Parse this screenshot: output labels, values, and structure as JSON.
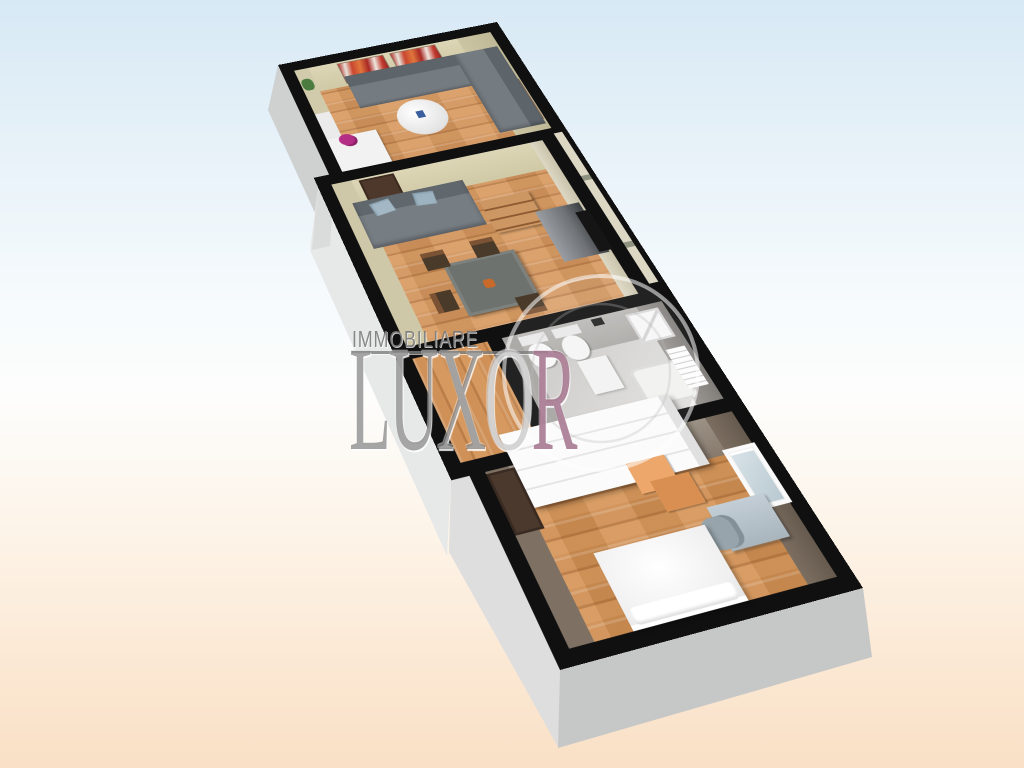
{
  "watermark": {
    "line1": "IMMOBILIARE",
    "logo_word": "LUXOR",
    "logo_letters": [
      "L",
      "U",
      "X",
      "O",
      "R"
    ],
    "colors": {
      "line1_gray": "#787878",
      "letters_gray": "#525252",
      "letter_o_gray": "#919191",
      "letter_r_mauve": "#945e7a",
      "ring_white": "#ffffff"
    }
  },
  "palette": {
    "background_top_blue": "#d7e9f5",
    "background_middle_white": "#fdfdfc",
    "background_bottom_peach": "#f9e0c6",
    "wall_cut_top_black": "#101010",
    "wall_interior_beige": "#d5cfae",
    "wall_interior_taupe": "#8f8276",
    "wall_interior_bath_gray": "#b3b1ae",
    "floor_wood_orange": "#d2945c",
    "floor_bathroom_gray": "#d0cfcd",
    "exterior_wall_gray": "#dcdddd",
    "exterior_wall_bottom_gray": "#c6c7c7",
    "sofa_gray": "#747b81",
    "pillow_blue": "#a3b8c4",
    "artwork_red": "#bf3b31",
    "door_brown": "#4e382b",
    "furniture_wood": "#c08a52",
    "fixture_white": "#f4f4f4"
  }
}
